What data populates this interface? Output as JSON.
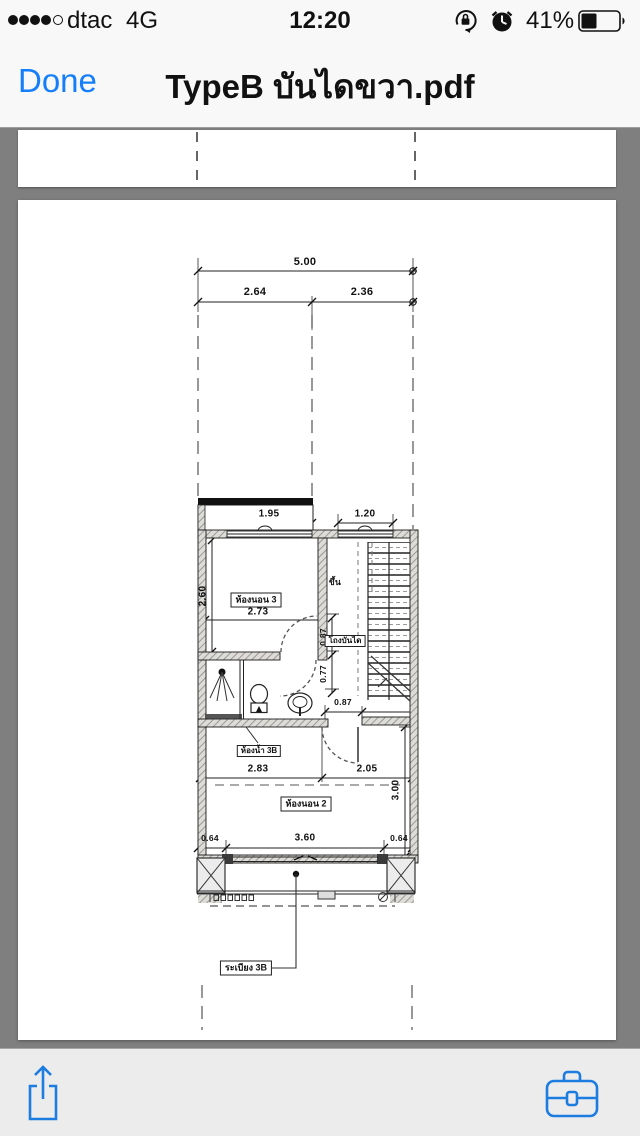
{
  "status_bar": {
    "carrier": "dtac",
    "network": "4G",
    "time": "12:20",
    "battery_percent": "41%",
    "signal_dots_filled": 4,
    "signal_dots_total": 5,
    "icons": [
      "orientation-lock-icon",
      "alarm-clock-icon",
      "battery-icon"
    ]
  },
  "nav_bar": {
    "done_label": "Done",
    "title": "TypeB บันไดขวา.pdf"
  },
  "colors": {
    "accent_blue": "#157efb",
    "toolbar_icon_blue": "#1d7ce0",
    "viewer_background": "#7f7f7f",
    "bar_background": "#f8f8f8",
    "toolbar_background": "#ececec",
    "page_background": "#ffffff",
    "line_color": "#1a1a1a"
  },
  "plan": {
    "dims": {
      "total": "5.00",
      "top_left": "2.64",
      "top_right": "2.36",
      "win_left": "1.95",
      "win_right": "1.20",
      "b3_h": "2.60",
      "b3_w": "2.73",
      "hall_a": "0.87",
      "hall_b": "0.77",
      "hall_door": "0.87",
      "bath_w": "2.83",
      "hall_w": "2.05",
      "b2_h": "3.00",
      "pier_l": "0.64",
      "door_w": "3.60",
      "pier_r": "0.64"
    },
    "rooms": {
      "bedroom3": "ห้องนอน 3",
      "stair_hall": "โถงบันได",
      "up": "ขึ้น",
      "bathroom": "ห้องน้ำ 3B",
      "bedroom2": "ห้องนอน 2",
      "balcony": "ระเบียง 3B"
    }
  },
  "toolbar": {
    "icons": [
      "share-icon",
      "toolbox-icon"
    ]
  }
}
